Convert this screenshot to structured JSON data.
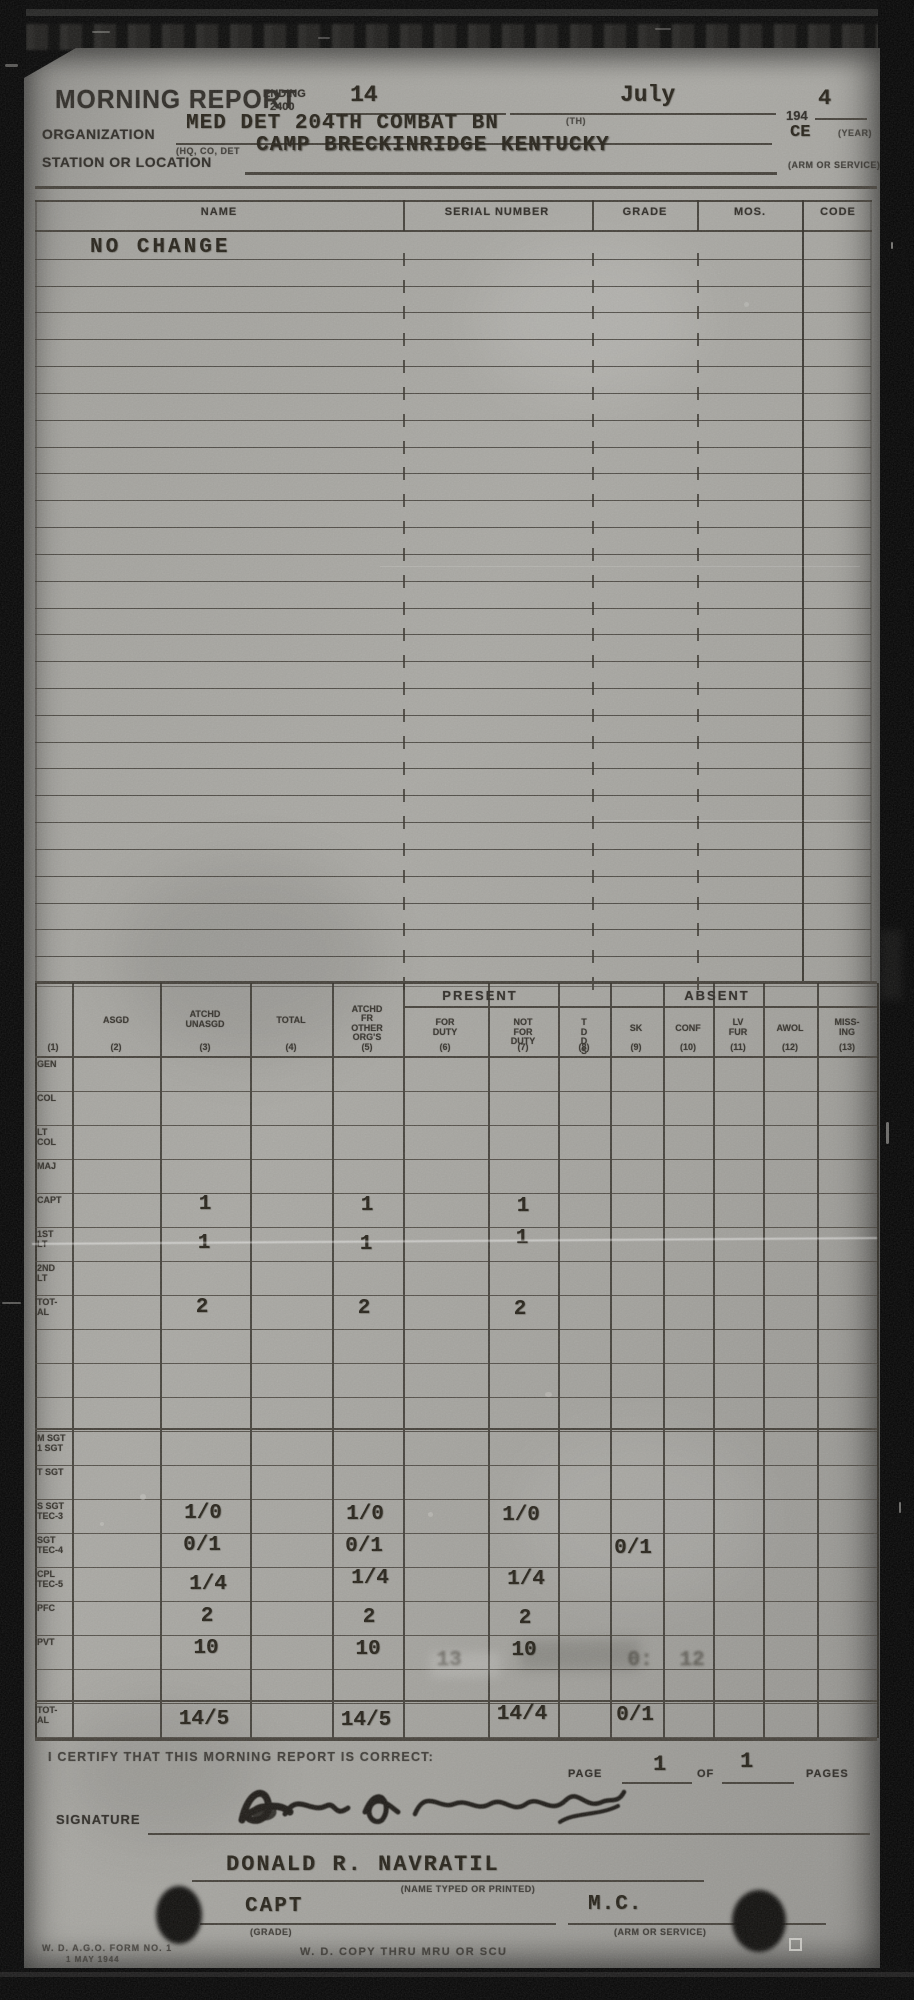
{
  "header": {
    "title": "MORNING REPORT",
    "ending_label": "ENDING",
    "ending_time": "2400",
    "day": "14",
    "month": "July",
    "year_printed": "194",
    "year_typed": "4",
    "year_caption": "(YEAR)",
    "organization_label": "ORGANIZATION",
    "organization_value": "MED DET 204TH COMBAT BN",
    "organization_sup": "(TH)",
    "organization_caption": "(HQ, CO, DET",
    "arm_service_value": "CE",
    "station_label": "STATION OR LOCATION",
    "station_value": "CAMP BRECKINRIDGE KENTUCKY",
    "arm_service_caption": "(ARM OR SERVICE)"
  },
  "roster": {
    "columns": [
      "NAME",
      "SERIAL NUMBER",
      "GRADE",
      "MOS.",
      "CODE"
    ],
    "entry": "NO CHANGE",
    "row_count": 28
  },
  "stats": {
    "present_label": "PRESENT",
    "absent_label": "ABSENT",
    "column_numbers": [
      "(1)",
      "(2)",
      "(3)",
      "(4)",
      "(5)",
      "(6)",
      "(7)",
      "(8)",
      "(9)",
      "(10)",
      "(11)",
      "(12)",
      "(13)"
    ],
    "column_labels": [
      "",
      "ASGD",
      "ATCHD\nUNASGD",
      "TOTAL",
      "ATCHD\nFR OTHER\nORG'S",
      "FOR\nDUTY",
      "NOT FOR\nDUTY",
      "T D\nD S",
      "SK",
      "CONF",
      "LV\nFUR",
      "AWOL",
      "MISS-\nING"
    ],
    "rows": [
      {
        "label": "GEN",
        "cells": {}
      },
      {
        "label": "COL",
        "cells": {}
      },
      {
        "label": "LT\nCOL",
        "cells": {}
      },
      {
        "label": "MAJ",
        "cells": {}
      },
      {
        "label": "CAPT",
        "cells": {
          "2": "1",
          "4": "1",
          "6": "1"
        }
      },
      {
        "label": "1ST\nLT",
        "cells": {
          "2": "1",
          "4": "1",
          "6": "1"
        }
      },
      {
        "label": "2ND\nLT",
        "cells": {}
      },
      {
        "label": "TOT-\nAL",
        "cells": {
          "2": "2",
          "4": "2",
          "6": "2"
        }
      },
      {
        "label": "",
        "cells": {}
      },
      {
        "label": "",
        "cells": {}
      },
      {
        "label": "",
        "cells": {}
      },
      {
        "label": "M SGT\n1 SGT",
        "cells": {}
      },
      {
        "label": "T SGT",
        "cells": {}
      },
      {
        "label": "S SGT\nTEC-3",
        "cells": {
          "2": "1/0",
          "4": "1/0",
          "6": "1/0"
        }
      },
      {
        "label": "SGT\nTEC-4",
        "cells": {
          "2": "0/1",
          "4": "0/1",
          "8": "0/1"
        }
      },
      {
        "label": "CPL\nTEC-5",
        "cells": {
          "2": "1/4",
          "4": "1/4",
          "6": "1/4"
        }
      },
      {
        "label": "PFC",
        "cells": {
          "2": "2",
          "4": "2",
          "6": "2"
        }
      },
      {
        "label": "PVT",
        "cells": {
          "2": "10",
          "4": "10",
          "6": "10"
        },
        "smudge_cells": {
          "5": "13",
          "8": "0:",
          "9": "12"
        }
      },
      {
        "label": "",
        "cells": {}
      },
      {
        "label": "TOT-\nAL",
        "cells": {
          "2": "14/5",
          "4": "14/5",
          "6": "14/4",
          "8": "0/1"
        }
      }
    ]
  },
  "certification": {
    "text": "I CERTIFY THAT THIS MORNING REPORT IS CORRECT:",
    "page_label": "PAGE",
    "page_value": "1",
    "of_label": "OF",
    "pages_value": "1",
    "pages_label": "PAGES",
    "signature_label": "SIGNATURE",
    "name_typed": "DONALD R. NAVRATIL",
    "name_caption": "(NAME TYPED OR PRINTED)",
    "grade_value": "CAPT",
    "grade_caption": "(GRADE)",
    "arm_value": "M.C.",
    "arm_caption": "(ARM OR SERVICE)"
  },
  "footer": {
    "form_line1": "W. D. A.G.O. FORM NO. 1",
    "form_line2": "1 MAY 1944",
    "copy_note": "W. D. COPY THRU MRU OR SCU"
  }
}
